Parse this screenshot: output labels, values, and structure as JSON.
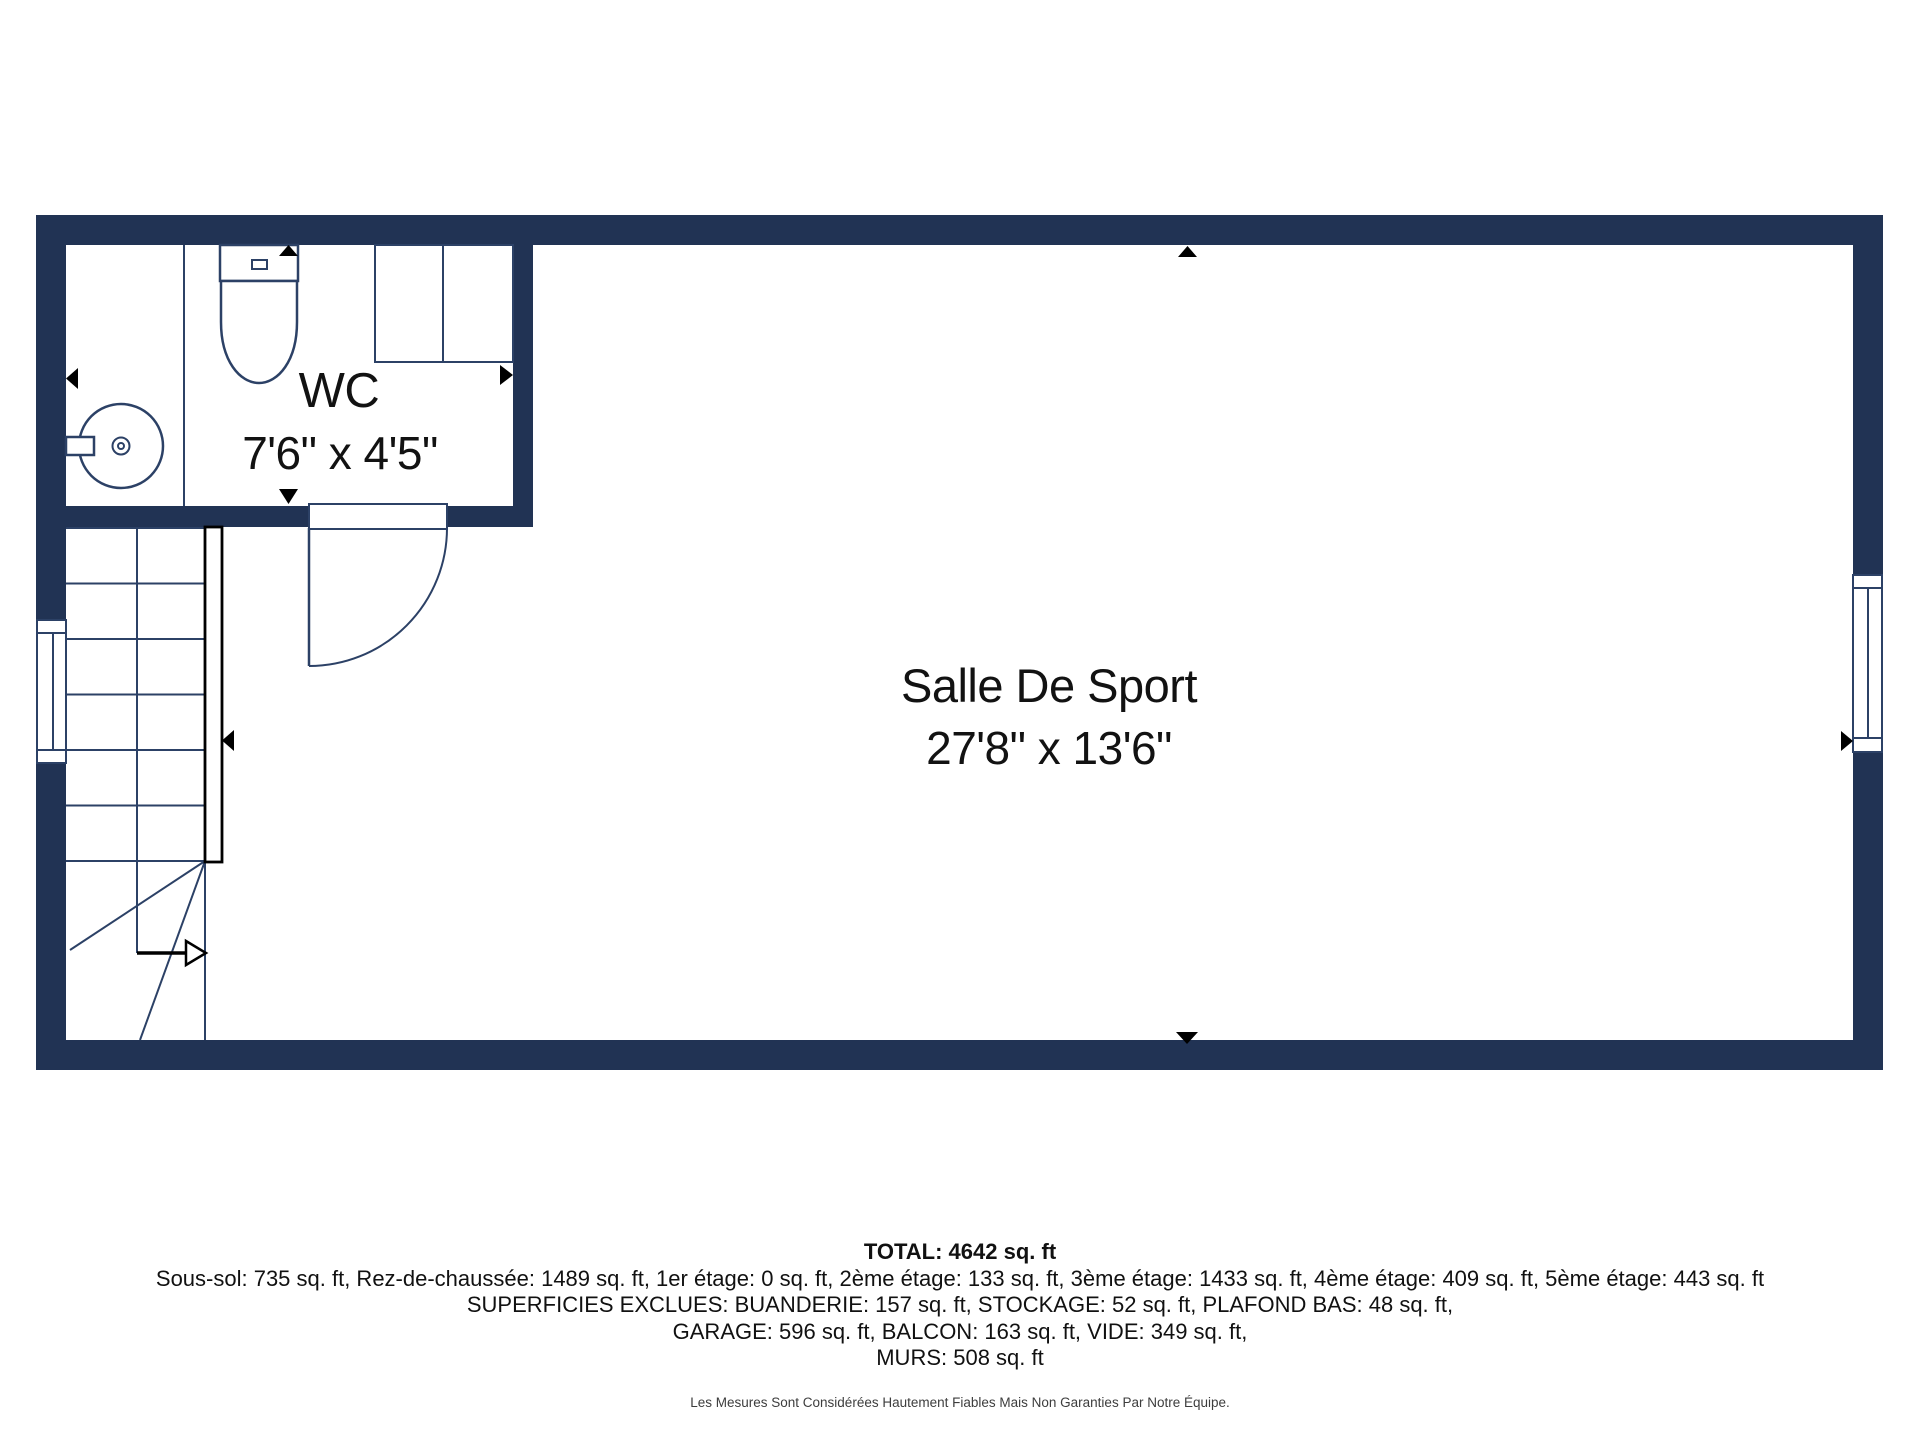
{
  "page": {
    "background": "#ffffff"
  },
  "floor_plan": {
    "colors": {
      "wall": "#213354",
      "thin_line": "#2c4166",
      "marker": "#000000",
      "label_text": "#121212"
    },
    "rooms": [
      {
        "name": "WC",
        "dimensions": "7'6\" x 4'5\""
      },
      {
        "name": "Salle De Sport",
        "dimensions": "27'8\" x 13'6\""
      }
    ],
    "features": [
      "staircase-with-handrail",
      "stair-direction-arrow",
      "door-swing",
      "toilet",
      "sink",
      "cabinet",
      "window-left-wall",
      "window-right-wall"
    ],
    "markers": [
      {
        "name": "arrow-up",
        "location": "wc-top"
      },
      {
        "name": "arrow-right",
        "location": "wc-right-wall"
      },
      {
        "name": "arrow-down",
        "location": "wc-bottom"
      },
      {
        "name": "arrow-left",
        "location": "left-wall"
      },
      {
        "name": "arrow-left",
        "location": "stair-handrail"
      },
      {
        "name": "arrow-up",
        "location": "top-wall-center"
      },
      {
        "name": "arrow-down",
        "location": "bottom-wall-center"
      },
      {
        "name": "arrow-right",
        "location": "right-wall-window"
      }
    ]
  },
  "summary": {
    "total": "TOTAL: 4642 sq. ft",
    "floors": "Sous-sol: 735 sq. ft, Rez-de-chaussée: 1489 sq. ft, 1er étage: 0 sq. ft, 2ème étage: 133 sq. ft, 3ème étage: 1433 sq. ft, 4ème étage: 409 sq. ft, 5ème étage: 443 sq. ft",
    "excluded": "SUPERFICIES EXCLUES: BUANDERIE: 157 sq. ft, STOCKAGE: 52 sq. ft, PLAFOND BAS: 48 sq. ft,",
    "excluded2": "GARAGE: 596 sq. ft, BALCON: 163 sq. ft, VIDE: 349 sq. ft,",
    "walls": "MURS: 508 sq. ft",
    "disclaimer": "Les Mesures Sont Considérées Hautement Fiables Mais Non Garanties Par Notre Équipe."
  }
}
